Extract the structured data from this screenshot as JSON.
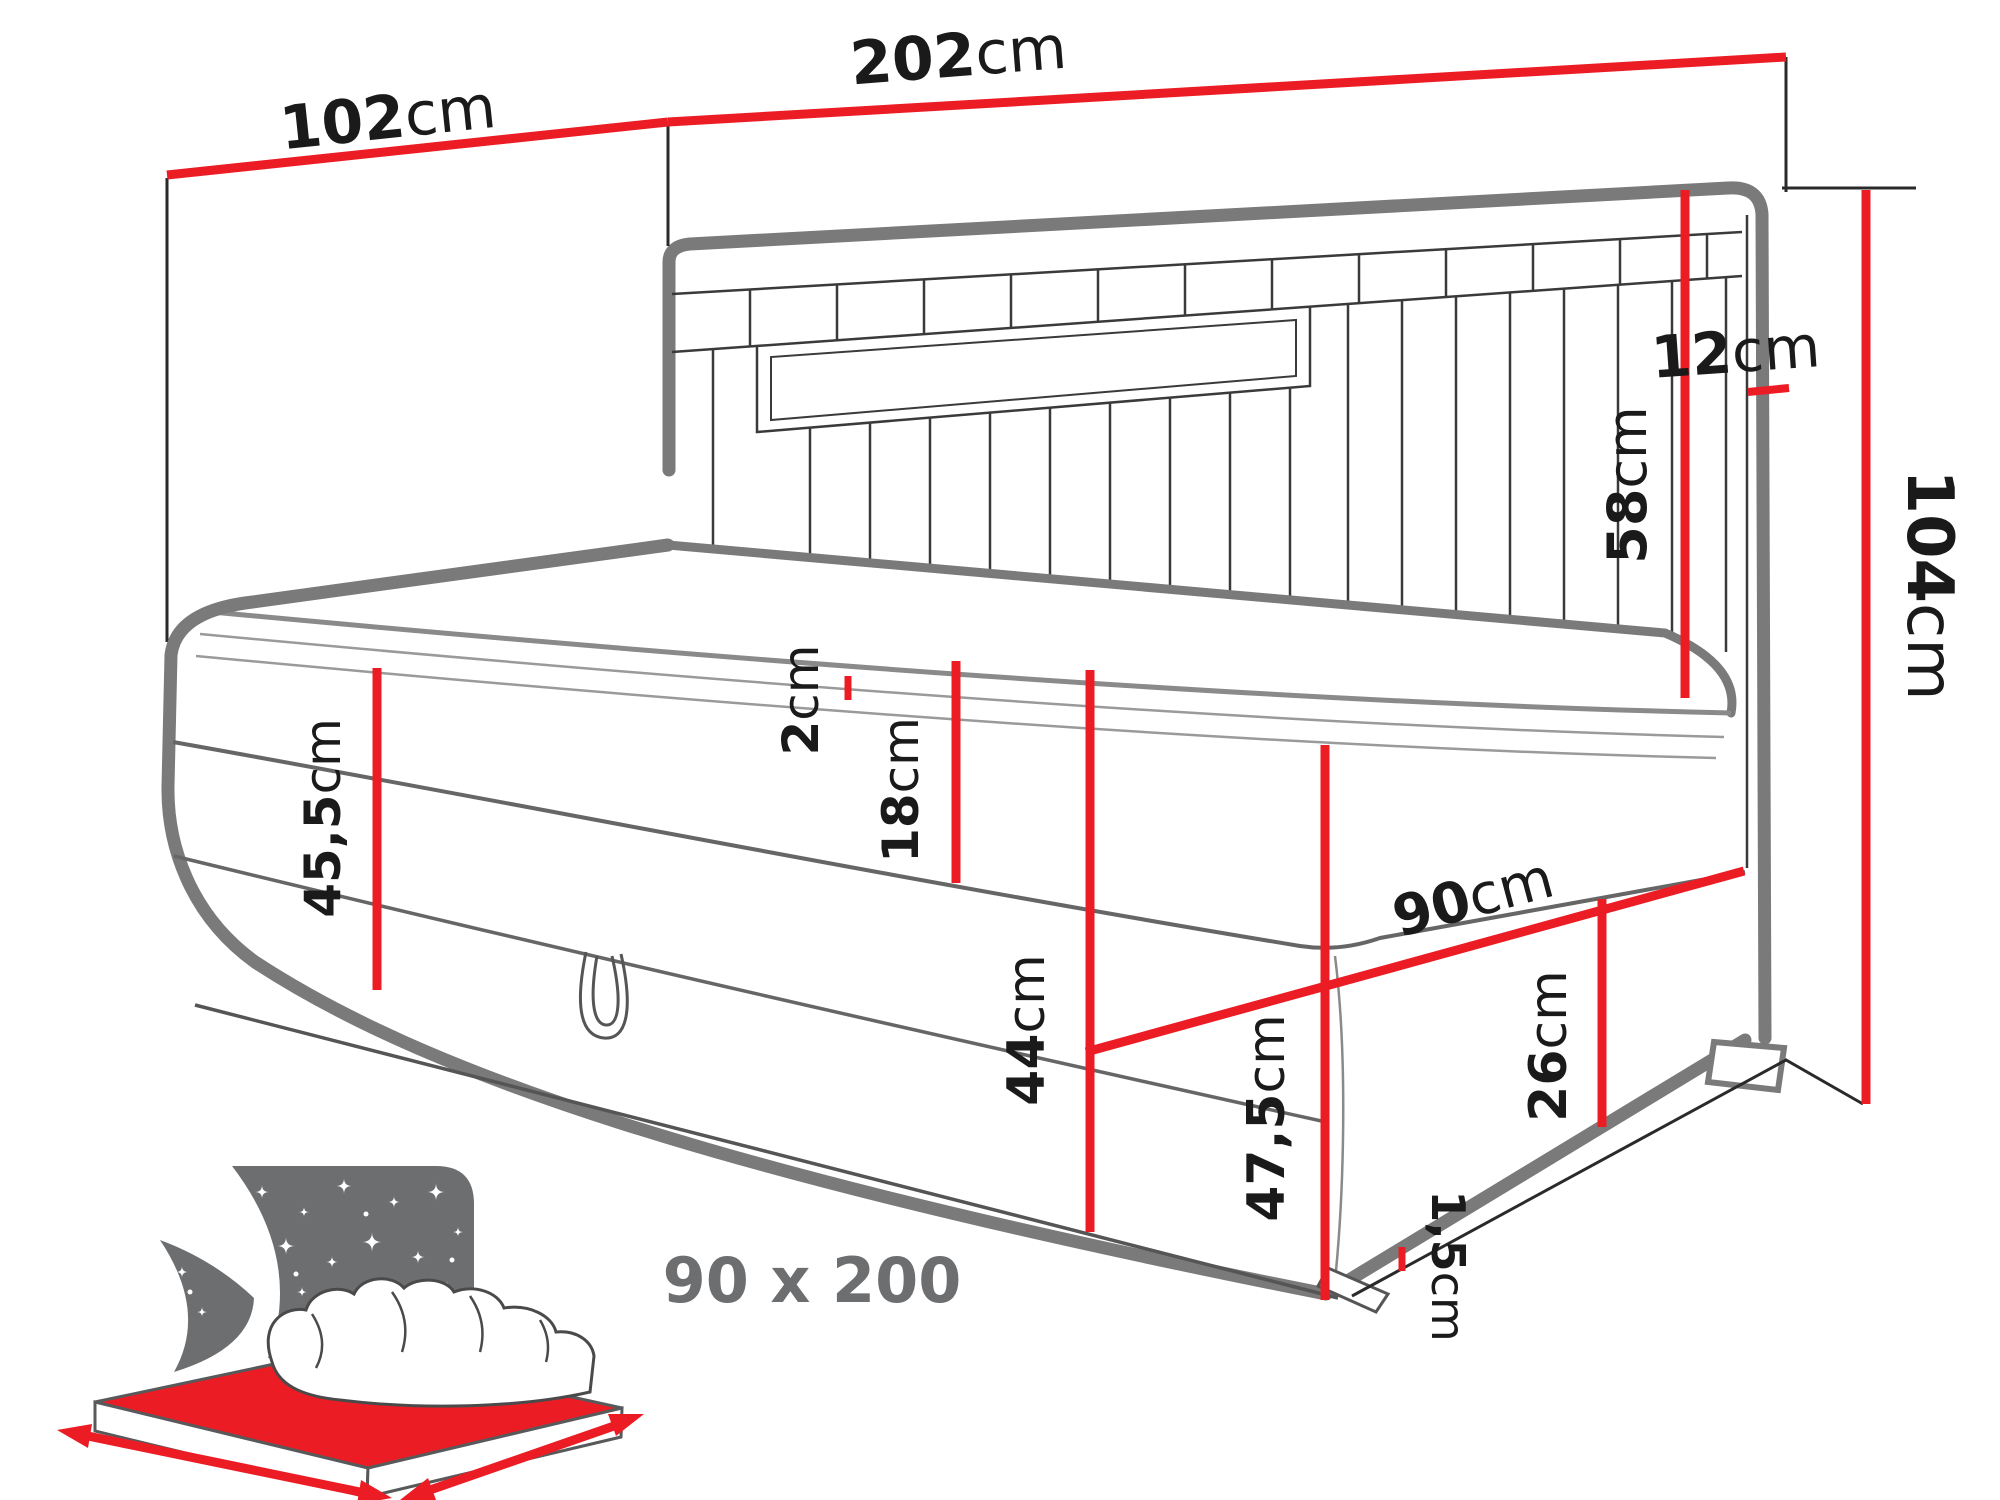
{
  "diagram": {
    "type": "furniture-dimension-drawing",
    "subject": "upholstered corner daybed (boxspring) with storage, channel-tufted headboard and side panel",
    "colors": {
      "dimension_accent": "#ec1c24",
      "outline_gray": "#7a7a7a",
      "label_text": "#1a1a1a",
      "icon_gray": "#6d6e70"
    },
    "dimensions": {
      "d102": {
        "value": "102",
        "unit": "cm",
        "meaning": "side panel width"
      },
      "d202": {
        "value": "202",
        "unit": "cm",
        "meaning": "headboard total width"
      },
      "d12": {
        "value": "12",
        "unit": "cm",
        "meaning": "headboard post depth"
      },
      "d58": {
        "value": "58",
        "unit": "cm",
        "meaning": "headboard height above mattress"
      },
      "d104": {
        "value": "104",
        "unit": "cm",
        "meaning": "total height"
      },
      "d455": {
        "value": "45,5",
        "unit": "cm",
        "meaning": "height at left end to mattress top"
      },
      "d2": {
        "value": "2",
        "unit": "cm",
        "meaning": "topper thickness"
      },
      "d18": {
        "value": "18",
        "unit": "cm",
        "meaning": "mattress thickness"
      },
      "d44": {
        "value": "44",
        "unit": "cm",
        "meaning": "base height"
      },
      "d90": {
        "value": "90",
        "unit": "cm",
        "meaning": "bed depth"
      },
      "d26": {
        "value": "26",
        "unit": "cm",
        "meaning": "side face height"
      },
      "d475": {
        "value": "47,5",
        "unit": "cm",
        "meaning": "corner height"
      },
      "d15": {
        "value": "1,5",
        "unit": "cm",
        "meaning": "glide / gap to floor"
      }
    },
    "icon": {
      "size_label": "90 x 200",
      "meaning": "sleeping surface dimensions in cm"
    }
  }
}
